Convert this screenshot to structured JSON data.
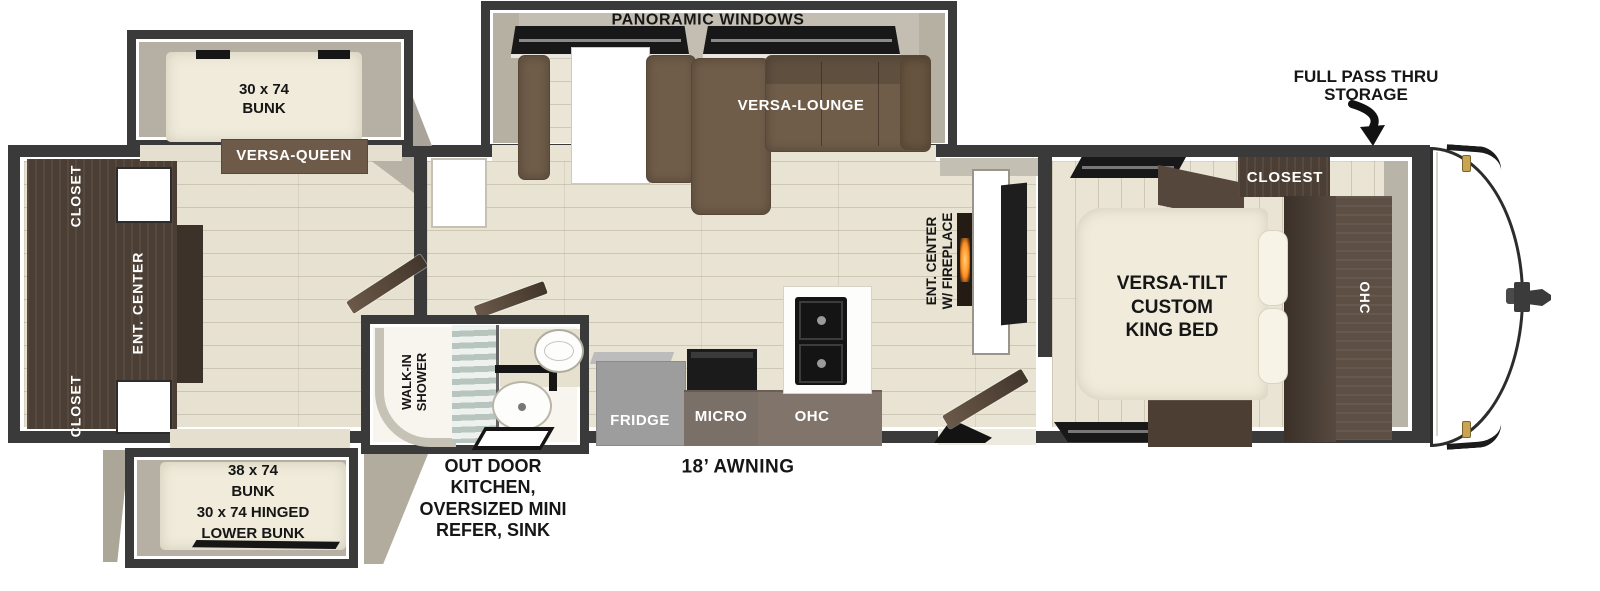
{
  "plan_title": "Travel Trailer Floor Plan",
  "labels": {
    "panoramic_windows": "PANORAMIC WINDOWS",
    "versa_lounge": "VERSA-LOUNGE",
    "versa_queen": "VERSA-QUEEN",
    "bunk_top": [
      "30 x 74",
      "BUNK"
    ],
    "bunk_bottom": [
      "38 x 74",
      "BUNK",
      "30 x 74 HINGED",
      "LOWER BUNK"
    ],
    "closet_rear_top": "CLOSET",
    "ent_center_rear": "ENT. CENTER",
    "closet_rear_bottom": "CLOSET",
    "walk_in_shower": [
      "WALK-IN",
      "SHOWER"
    ],
    "fridge": "FRIDGE",
    "micro": "MICRO",
    "ohc_kitchen": "OHC",
    "ent_center_fireplace": [
      "ENT. CENTER",
      "W/ FIREPLACE"
    ],
    "king_bed": [
      "VERSA-TILT",
      "CUSTOM",
      "KING BED"
    ],
    "closet_bedroom": "CLOSEST",
    "ohc_bedroom": "OHC",
    "full_pass_thru": [
      "FULL PASS THRU",
      "STORAGE"
    ],
    "awning": "18’ AWNING",
    "outdoor_kitchen": [
      "OUT DOOR",
      "KITCHEN,",
      "OVERSIZED MINI",
      "REFER, SINK"
    ]
  },
  "colors": {
    "wall": "#3a3a3a",
    "floor_plank": "#e6e1d0",
    "slide_gray": "#b3ada1",
    "sofa_brown": "#6f5c49",
    "cabinet_wood": "#4b3e34",
    "kitchen_cabinet": "#7b7068",
    "fridge_gray": "#9d9d9d",
    "mattress_cream": "#f0ebdb",
    "appliance_black": "#161616",
    "fireplace_flame": "#ff8c1e",
    "marker_light_gold": "#c9a553"
  }
}
